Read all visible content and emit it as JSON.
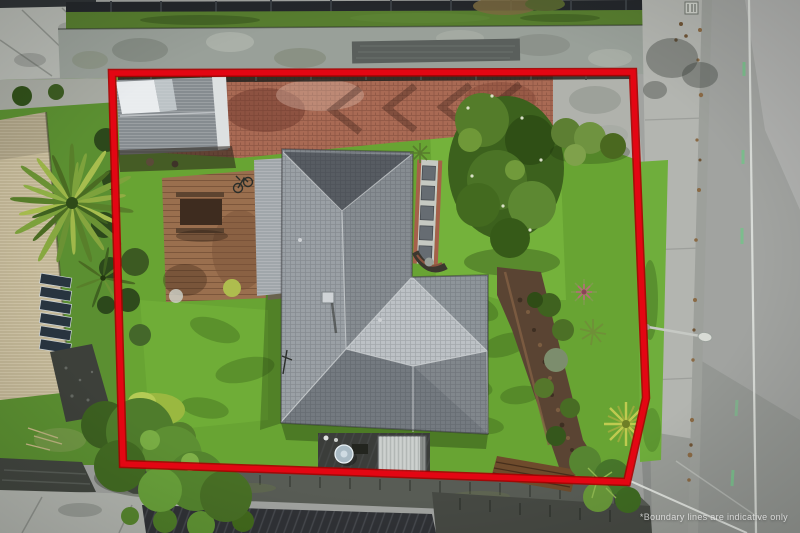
{
  "image": {
    "type": "aerial-property-photo",
    "watermark": "*Boundary lines are indicative only"
  },
  "colors": {
    "boundary-red": "#e30613",
    "lawn-green": "#68a433",
    "roof-gray": "#81878c",
    "brick-red": "#a96a54",
    "road-gray": "#a1a3a0",
    "concrete-gray": "#b4b6b1",
    "foliage-green": "#4b7326",
    "deck-brown": "#9a6f4e",
    "watermark-white": "rgba(255,255,255,0.72)"
  },
  "scene": {
    "description": "Aerial drone photo of a residential property outlined with a red boundary overlay; street on the right, neighbouring houses left, watermark bottom right",
    "elements": [
      "red-boundary-overlay",
      "main-house-roof",
      "garage-roof",
      "timber-deck",
      "outdoor-table",
      "bicycle",
      "brick-driveway",
      "palm-tree",
      "lawns",
      "garden-bed",
      "large-tree",
      "neighbour-house-solar-panels",
      "road",
      "footpath",
      "grass-berm",
      "street-light",
      "power-lines",
      "retaining-walls",
      "satellite-dish",
      "carport",
      "stepping-stone-path",
      "watermark"
    ]
  }
}
